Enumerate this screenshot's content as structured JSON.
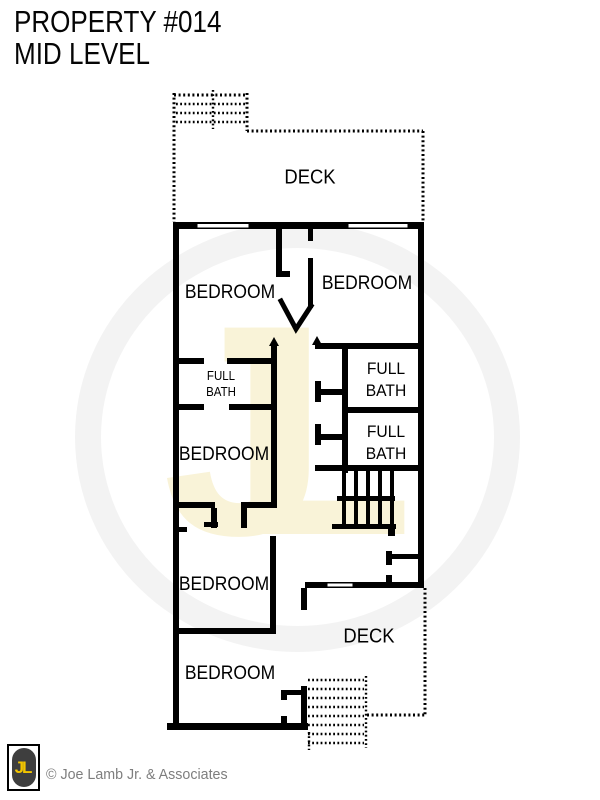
{
  "header": {
    "title_line1": "PROPERTY #014",
    "title_line2": "MID LEVEL"
  },
  "plan": {
    "watermark_monogram": "JL",
    "labels": [
      {
        "id": "deck-top",
        "text": "DECK"
      },
      {
        "id": "bedroom-top-left",
        "text": "BEDROOM"
      },
      {
        "id": "bedroom-top-right",
        "text": "BEDROOM"
      },
      {
        "id": "full-bath-left",
        "line1": "FULL",
        "line2": "BATH"
      },
      {
        "id": "full-bath-right-upper",
        "line1": "FULL",
        "line2": "BATH"
      },
      {
        "id": "full-bath-right-lower",
        "line1": "FULL",
        "line2": "BATH"
      },
      {
        "id": "bedroom-mid-left",
        "text": "BEDROOM"
      },
      {
        "id": "bedroom-lower-left",
        "text": "BEDROOM"
      },
      {
        "id": "bedroom-bottom",
        "text": "BEDROOM"
      },
      {
        "id": "deck-bottom",
        "text": "DECK"
      }
    ]
  },
  "footer": {
    "logo_monogram": "JL",
    "credit": "© Joe Lamb Jr. & Associates"
  },
  "colors": {
    "wall": "#000000",
    "watermark_ring": "#f3f3f3",
    "watermark_cream": "#f9f3d8",
    "logo_yellow": "#f2c500",
    "logo_dark": "#3e3e3e",
    "credit_gray": "#7e7e7e"
  }
}
